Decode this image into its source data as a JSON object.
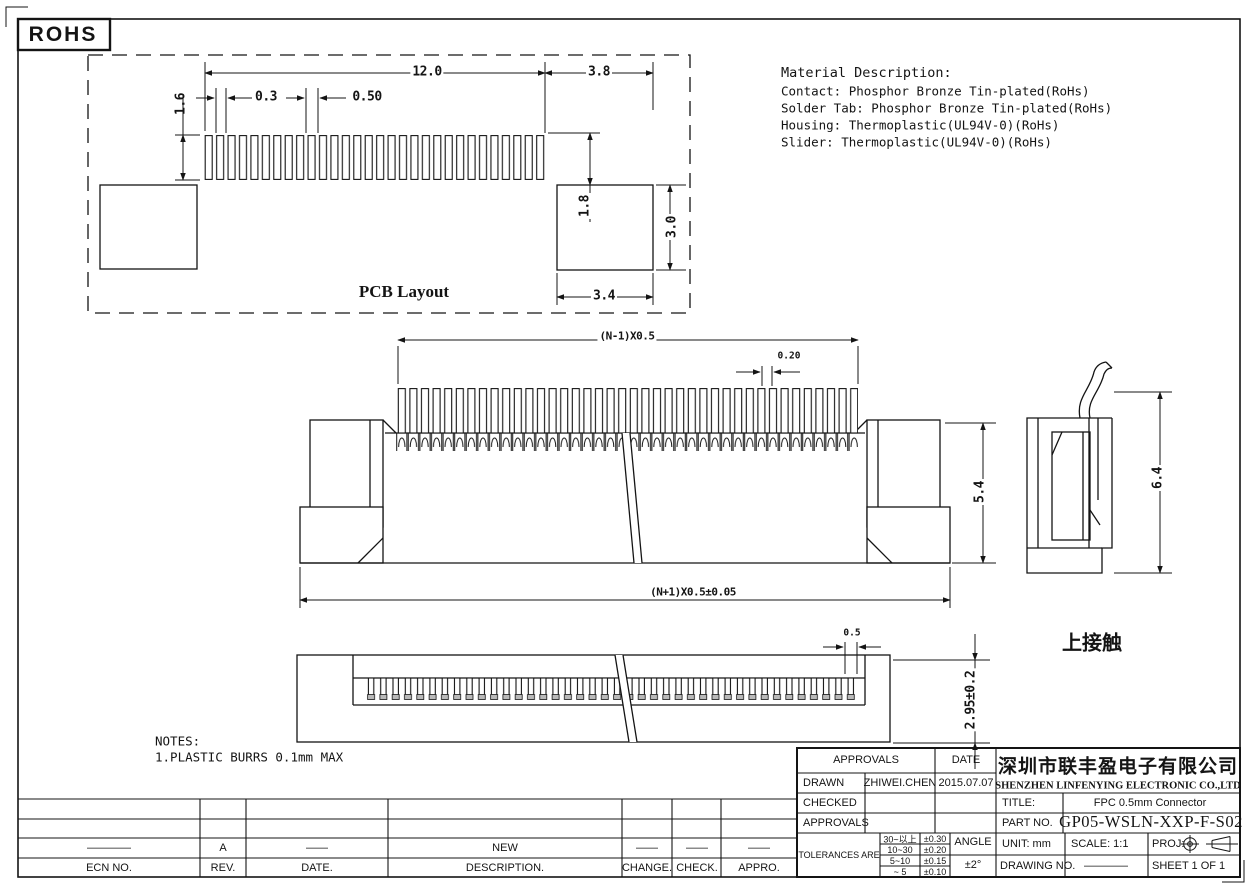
{
  "sheet": {
    "rohs": "ROHS"
  },
  "pcb_layout": {
    "title": "PCB Layout",
    "dim_pad_row_width": "12.0",
    "dim_right_gap": "3.8",
    "dim_pad_width": "0.3",
    "dim_pitch": "0.50",
    "dim_pad_height": "1.6",
    "dim_vertical_gap": "1.8",
    "dim_anchor_height": "3.0",
    "dim_anchor_width": "3.4"
  },
  "material_description": {
    "title": "Material Description:",
    "lines": [
      "Contact: Phosphor Bronze Tin-plated(RoHs)",
      "Solder Tab: Phosphor Bronze Tin-plated(RoHs)",
      "Housing: Thermoplastic(UL94V-0)(RoHs)",
      "Slider: Thermoplastic(UL94V-0)(RoHs)"
    ]
  },
  "front_view": {
    "dim_pin_span": "(N-1)X0.5",
    "dim_pin_width": "0.20",
    "dim_height": "5.4",
    "dim_total_width": "(N+1)X0.5±0.05"
  },
  "side_view": {
    "dim_height": "6.4"
  },
  "bottom_view": {
    "dim_pitch": "0.5",
    "dim_depth": "2.95±0.2",
    "label": "上接触"
  },
  "notes": {
    "title": "NOTES:",
    "items": [
      "1.PLASTIC BURRS 0.1mm MAX"
    ]
  },
  "revision_table": {
    "headers": [
      "ECN NO.",
      "REV.",
      "DATE.",
      "DESCRIPTION.",
      "CHANGE.",
      "CHECK.",
      "APPRO."
    ],
    "rows": [
      [
        "————",
        "A",
        "——",
        "NEW",
        "——",
        "——",
        "——"
      ]
    ]
  },
  "title_block": {
    "approvals_header": "APPROVALS",
    "date_header": "DATE",
    "drawn_label": "DRAWN",
    "drawn_name": "ZHIWEI.CHEN",
    "drawn_date": "2015.07.07",
    "checked_label": "CHECKED",
    "approved_label": "APPROVALS",
    "tolerances_label": "TOLERANCES ARE",
    "tolerance_rows": [
      [
        "30~以上",
        "±0.30"
      ],
      [
        "10~30",
        "±0.20"
      ],
      [
        "5~10",
        "±0.15"
      ],
      [
        "~ 5",
        "±0.10"
      ]
    ],
    "angle_label": "ANGLE",
    "angle_value": "±2°",
    "company_cn": "深圳市联丰盈电子有限公司",
    "company_en": "SHENZHEN LINFENYING ELECTRONIC CO.,LTD",
    "title_label": "TITLE:",
    "title_value": "FPC 0.5mm Connector",
    "part_no_label": "PART NO.",
    "part_no_value": "GP05-WSLN-XXP-F-S02",
    "unit_label": "UNIT: mm",
    "scale_label": "SCALE: 1:1",
    "proj_label": "PROJ:",
    "drawing_no_label": "DRAWING NO.",
    "drawing_no_value": "————",
    "sheet_label": "SHEET 1 OF 1"
  },
  "colors": {
    "line": "#141414",
    "background": "#ffffff"
  }
}
